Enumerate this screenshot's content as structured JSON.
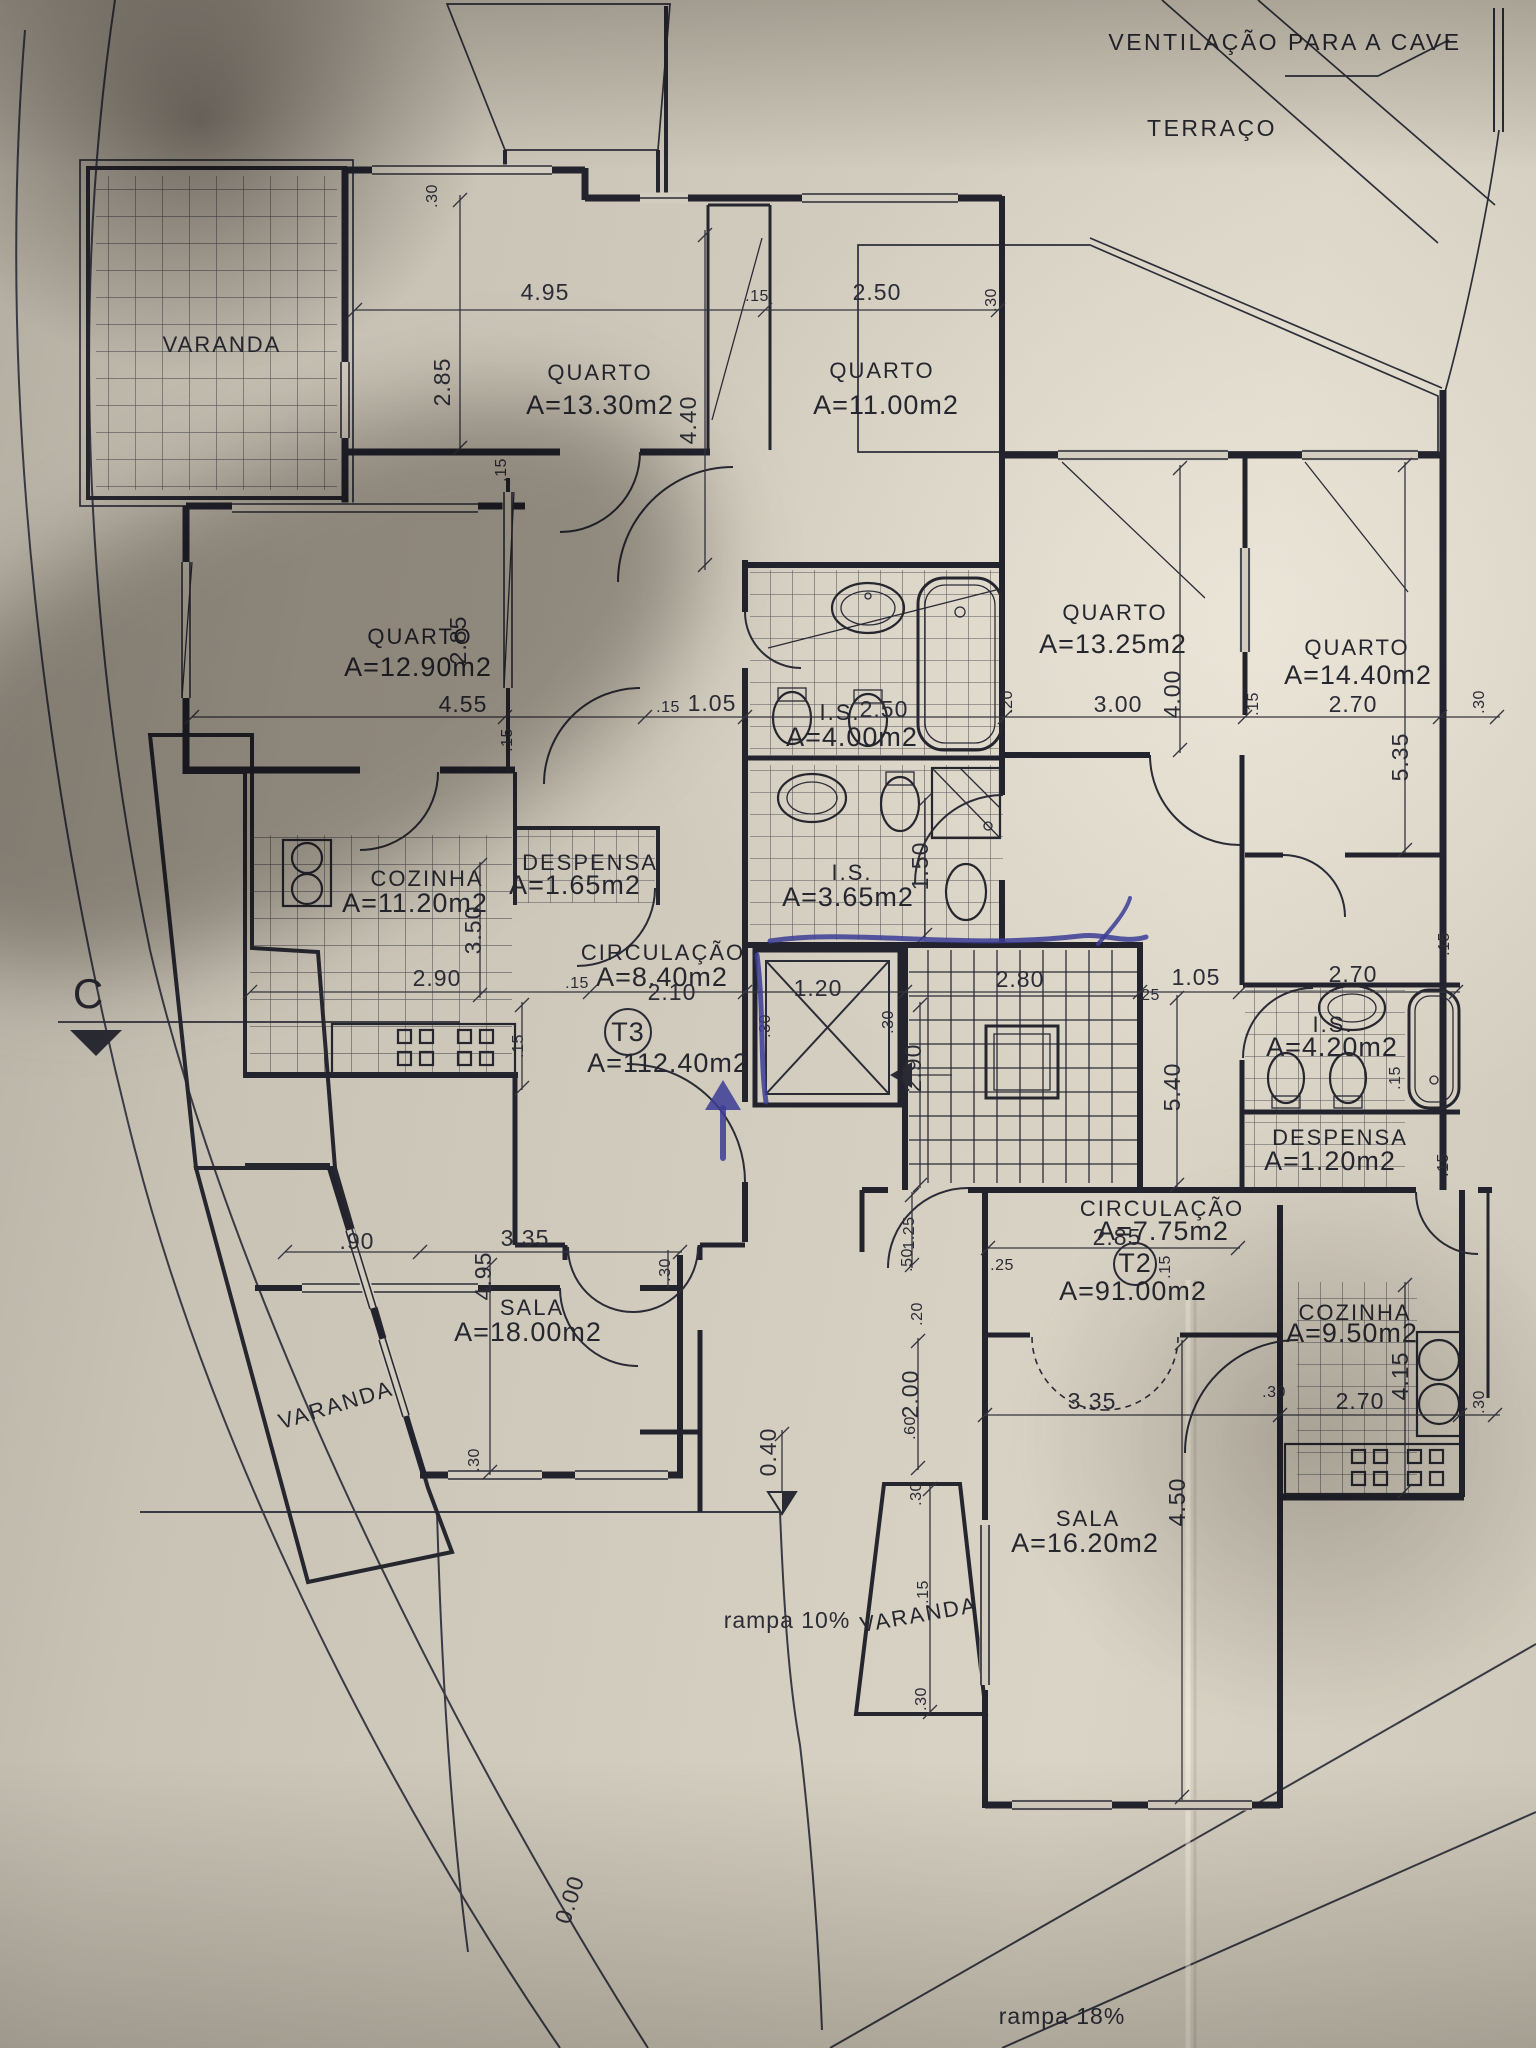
{
  "colors": {
    "ink": "#26262e",
    "pen_blue": "#3c3c96",
    "paper": "#cfc9bb"
  },
  "notes": {
    "ventilacao": "VENTILAÇÃO PARA A CAVE",
    "terraco": "TERRAÇO",
    "section": "C",
    "rampa_10": "rampa 10%",
    "rampa_18": "rampa 18%",
    "level_0": "0.00",
    "level_040": "0.40"
  },
  "t3": {
    "code": "T3",
    "area": "A=112.40m2",
    "varanda_top": "VARANDA",
    "varanda_bottom": "VARANDA",
    "quarto1": {
      "name": "QUARTO",
      "area": "A=13.30m2"
    },
    "quarto2": {
      "name": "QUARTO",
      "area": "A=11.00m2"
    },
    "quarto3": {
      "name": "QUARTO",
      "area": "A=12.90m2"
    },
    "cozinha": {
      "name": "COZINHA",
      "area": "A=11.20m2"
    },
    "despensa": {
      "name": "DESPENSA",
      "area": "A=1.65m2"
    },
    "circulacao": {
      "name": "CIRCULAÇÃO",
      "area": "A=8.40m2"
    },
    "is1": {
      "name": "I.S.",
      "area": "A=4.00m2"
    },
    "is2": {
      "name": "I.S.",
      "area": "A=3.65m2"
    },
    "sala": {
      "name": "SALA",
      "area": "A=18.00m2"
    }
  },
  "t2": {
    "code": "T2",
    "area": "A=91.00m2",
    "varanda": "VARANDA",
    "quarto1": {
      "name": "QUARTO",
      "area": "A=13.25m2"
    },
    "quarto2": {
      "name": "QUARTO",
      "area": "A=14.40m2"
    },
    "is1": {
      "name": "I.S.",
      "area": "A=4.20m2"
    },
    "despensa": {
      "name": "DESPENSA",
      "area": "A=1.20m2"
    },
    "circulacao": {
      "name": "CIRCULAÇÃO",
      "area": "A=7.75m2"
    },
    "cozinha": {
      "name": "COZINHA",
      "area": "A=9.50m2"
    },
    "sala": {
      "name": "SALA",
      "area": "A=16.20m2"
    }
  },
  "dims": {
    "d30a": ".30",
    "d495a": "4.95",
    "d15a": ".15",
    "d250a": "2.50",
    "d30b": ".30",
    "d285a": "2.85",
    "d440": "4.40",
    "d15b": ".15",
    "d15m": ".15",
    "d285b": "2.85",
    "d455": "4.55",
    "d15c": ".15",
    "d105a": "1.05",
    "d250b": "2.50",
    "d20a": ".20",
    "d300": "3.00",
    "d400": "4.00",
    "d15e": ".15",
    "d270a": "2.70",
    "d30c": ".30",
    "d535": "5.35",
    "d290a": "2.90",
    "d15f": ".15",
    "d350": "3.50",
    "d15g": ".15",
    "d210": "2.10",
    "d120": "1.20",
    "d30d": ".30",
    "d30e": ".30",
    "d280": "2.80",
    "d290b": "2.90",
    "d25a": ".25",
    "d105b": "1.05",
    "d540": "5.40",
    "d150": "1.50",
    "d270b": "2.70",
    "d15h": ".15",
    "d15i": ".15",
    "d15j": ".15",
    "d285c": "2.85",
    "d25b": ".25",
    "d15n": ".15",
    "d125": "1.25",
    "d50": ".50",
    "d20b": ".20",
    "d200": "2.00",
    "d60": ".60",
    "d90": ".90",
    "d335b": "3.35",
    "d495b": "4.95",
    "d30g": ".30",
    "d30h": ".30",
    "d335a": "3.35",
    "d30f": ".30",
    "d270c": "2.70",
    "d415": "4.15",
    "d30k": ".30",
    "d450": "4.50",
    "d30i": ".30",
    "d15k": ".15",
    "d30j": ".30"
  }
}
